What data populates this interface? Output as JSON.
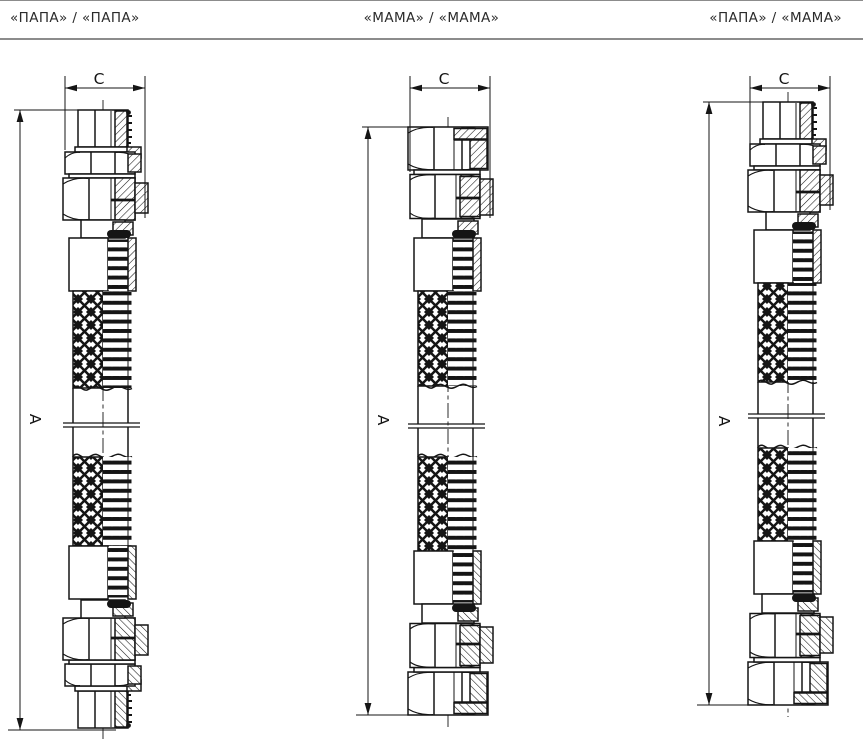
{
  "header": {
    "labels": [
      {
        "text": "«ПАПА» / «ПАПА»"
      },
      {
        "text": "«МАМА» / «МАМА»"
      },
      {
        "text": "«ПАПА» / «МАМА»"
      }
    ]
  },
  "diagrams": [
    {
      "id": "papa-papa",
      "top_connector": "ПАПА",
      "bottom_connector": "ПАПА",
      "dim_width_label": "C",
      "dim_length_label": "A"
    },
    {
      "id": "mama-mama",
      "top_connector": "МАМА",
      "bottom_connector": "МАМА",
      "dim_width_label": "C",
      "dim_length_label": "A"
    },
    {
      "id": "papa-mama",
      "top_connector": "ПАПА",
      "bottom_connector": "МАМА",
      "dim_width_label": "C",
      "dim_length_label": "A"
    }
  ],
  "colors": {
    "line": "#151515",
    "header_rule": "#8c8c8c",
    "background": "#ffffff"
  }
}
